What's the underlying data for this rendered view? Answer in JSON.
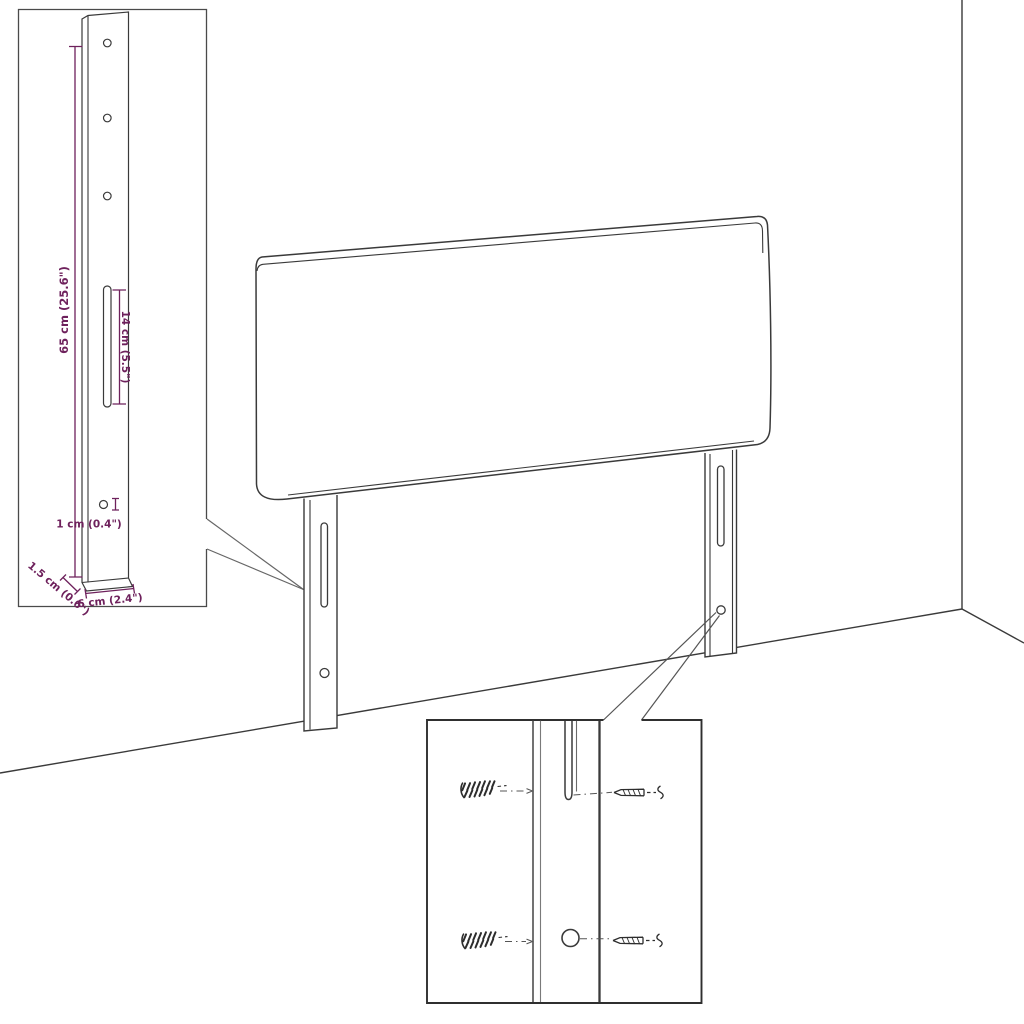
{
  "figure": {
    "kind": "product dimension diagram",
    "subject": "upholstered headboard with two wall-mount legs, bracket detail inset and screw/wall-plug mounting detail"
  },
  "colors": {
    "background": "#ffffff",
    "line_art": "#3a3a3a",
    "soft_line": "#6a6a6a",
    "dimension": "#6e215c"
  },
  "inset_detail": {
    "labels": {
      "bracket_height": "65 cm (25.6\")",
      "slot_length": "14 cm (5.5\")",
      "hole_diameter": "1 cm (0.4\")",
      "bracket_depth": "1.5 cm (0.6\")",
      "bracket_width": "6 cm (2.4\")"
    }
  },
  "mounting_detail": {
    "parts": {
      "wall_plug": "wall plug",
      "screw": "screw"
    }
  }
}
